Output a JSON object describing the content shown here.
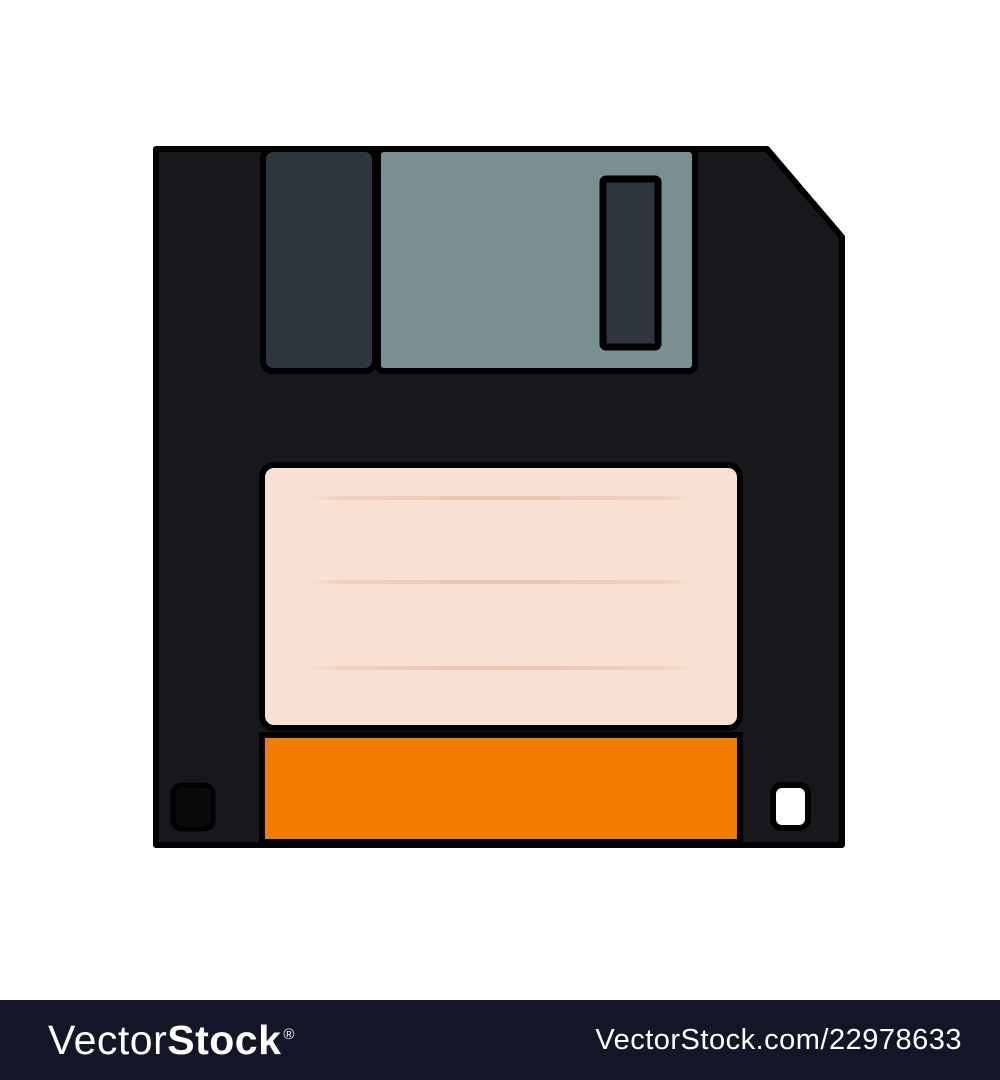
{
  "illustration": {
    "name": "floppy-disk-flat-icon",
    "parts": [
      "disk-body-with-cut-corner",
      "metal-shutter-left-window",
      "metal-shutter-plate",
      "shutter-slot",
      "paper-label-with-ruled-lines",
      "orange-color-stripe",
      "write-protect-hole-dark",
      "hd-hole-light"
    ],
    "label_line_count": 3
  },
  "colors": {
    "background": "#ffffff",
    "disk-body": "#17181b",
    "outline": "#000000",
    "shutter-left": "#2e353e",
    "shutter-plate": "#798f90",
    "slot-fill": "#2e353e",
    "label": "#f8e1d3",
    "label-line": "#eac7b4",
    "stripe": "#f17c00",
    "hole-dark": "#0a0a0c",
    "hole-light": "#ffffff",
    "bar-bg": "#141527",
    "bar-text": "#ffffff"
  },
  "watermark_bar": {
    "logo_light": "Vector",
    "logo_bold": "Stock",
    "logo_registered": "®",
    "reference": "VectorStock.com/22978633"
  }
}
